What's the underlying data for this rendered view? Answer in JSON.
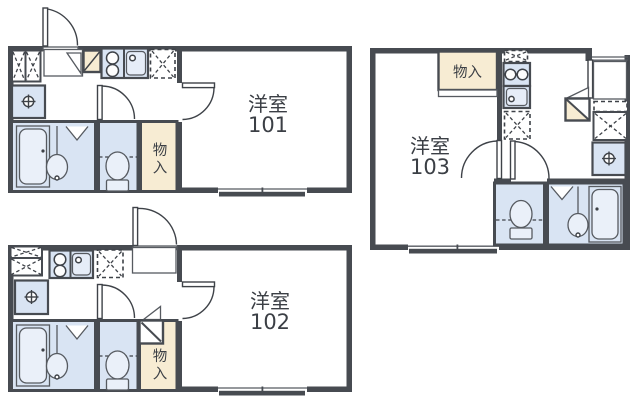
{
  "floorplan": {
    "units": [
      {
        "id": "101",
        "room_label": "洋室",
        "room_number": "101",
        "storage_label": "物入"
      },
      {
        "id": "102",
        "room_label": "洋室",
        "room_number": "102",
        "storage_label": "物入"
      },
      {
        "id": "103",
        "room_label": "洋室",
        "room_number": "103",
        "storage_label": "物入"
      }
    ],
    "colors": {
      "wall": "#474b51",
      "fixture_fill": "#d9e4f3",
      "storage_fill": "#f7ecd3",
      "background": "#ffffff",
      "text": "#3b3f45"
    }
  }
}
